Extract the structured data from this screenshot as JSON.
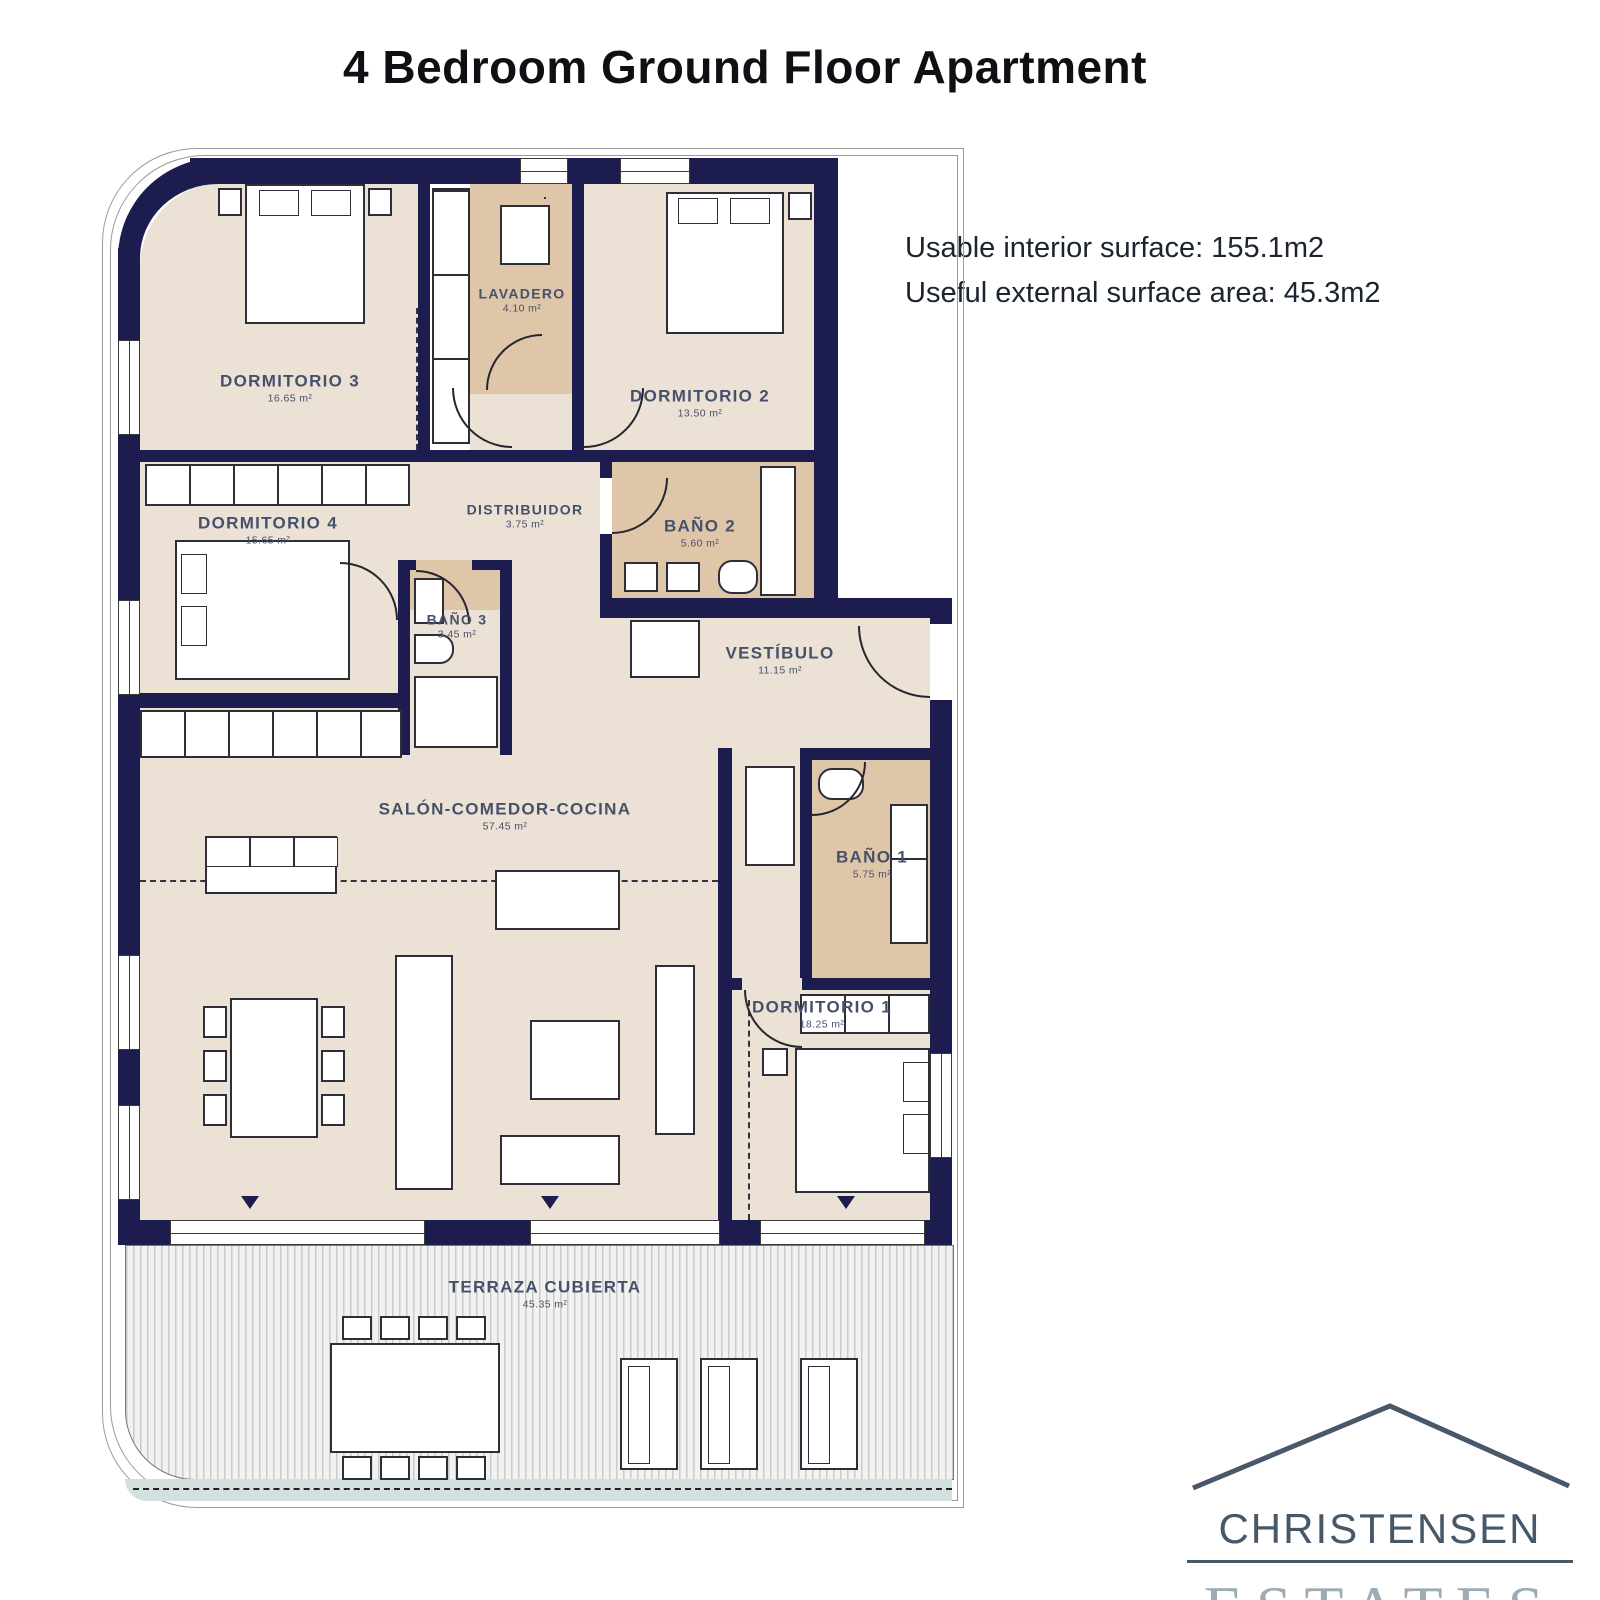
{
  "page": {
    "title": "4 Bedroom Ground Floor Apartment"
  },
  "surface_info": {
    "line1": "Usable interior surface: 155.1m2",
    "line2": "Useful external surface area: 45.3m2"
  },
  "floorplan": {
    "rooms": [
      {
        "id": "dormitorio3",
        "label": "DORMITORIO 3",
        "area": "16.65 m²"
      },
      {
        "id": "lavadero",
        "label": "LAVADERO",
        "area": "4.10 m²"
      },
      {
        "id": "dormitorio2",
        "label": "DORMITORIO 2",
        "area": "13.50 m²"
      },
      {
        "id": "dormitorio4",
        "label": "DORMITORIO 4",
        "area": "15.65 m²"
      },
      {
        "id": "distribuidor",
        "label": "DISTRIBUIDOR",
        "area": "3.75 m²"
      },
      {
        "id": "bano2",
        "label": "BAÑO 2",
        "area": "5.60 m²"
      },
      {
        "id": "bano3",
        "label": "BAÑO 3",
        "area": "3.45 m²"
      },
      {
        "id": "vestibulo",
        "label": "VESTÍBULO",
        "area": "11.15 m²"
      },
      {
        "id": "salon",
        "label": "SALÓN-COMEDOR-COCINA",
        "area": "57.45 m²"
      },
      {
        "id": "bano1",
        "label": "BAÑO 1",
        "area": "5.75 m²"
      },
      {
        "id": "dormitorio1",
        "label": "DORMITORIO 1",
        "area": "18.25 m²"
      },
      {
        "id": "terraza",
        "label": "TERRAZA CUBIERTA",
        "area": "45.35 m²"
      }
    ],
    "colors": {
      "wall": "#1c1c4f",
      "room_fill": "#ece1d5",
      "wet_room_fill": "#dfc6a9",
      "label_text": "#45516b",
      "terrace_rim": "#d2e1e0"
    }
  },
  "logo": {
    "name_top": "CHRISTENSEN",
    "name_bottom": "ESTATES",
    "colors": {
      "top": "#475869",
      "bottom": "#9cabb4"
    }
  }
}
